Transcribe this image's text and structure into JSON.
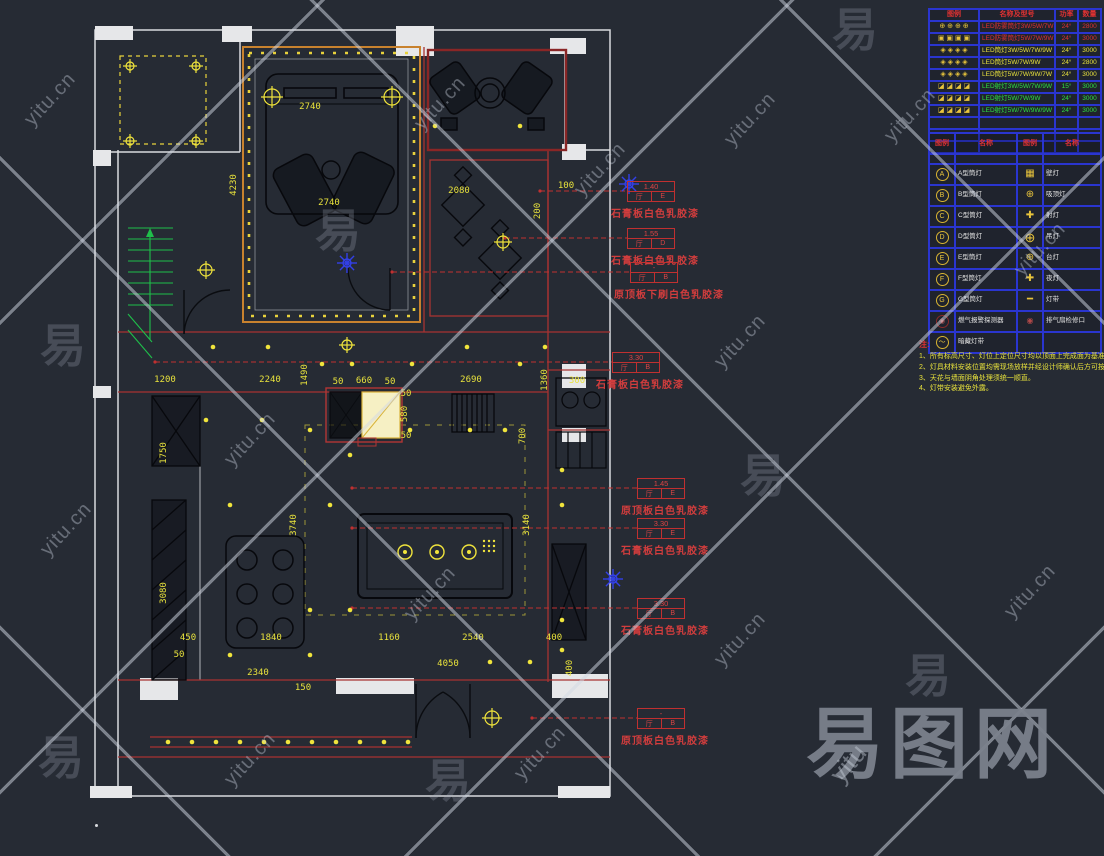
{
  "watermark": {
    "url": "yitu.cn",
    "glyph": "易",
    "brand": "易图网",
    "brand_sub": "yitu"
  },
  "fixture_legend": {
    "headers": [
      "图例",
      "名称及型号",
      "功率",
      "数量"
    ],
    "rows": [
      {
        "sym": "⊕ ⊕ ⊕ ⊕",
        "color": "red",
        "name": "LED防雾筒灯3W/5W/7W",
        "power": "24°",
        "qty": "2800"
      },
      {
        "sym": "▣ ▣ ▣ ▣",
        "color": "red",
        "name": "LED防雾筒灯5W/7W/9W",
        "power": "24°",
        "qty": "3000"
      },
      {
        "sym": "◈ ◈ ◈ ◈",
        "color": "yellow",
        "name": "LED筒灯3W/5W/7W/9W",
        "power": "24°",
        "qty": "3000"
      },
      {
        "sym": "◈ ◈ ◈ ◈",
        "color": "yellow",
        "name": "LED筒灯5W/7W/9W",
        "power": "24°",
        "qty": "2800"
      },
      {
        "sym": "◈ ◈ ◈ ◈",
        "color": "yellow",
        "name": "LED筒灯5W/7W/9W/7W",
        "power": "24°",
        "qty": "3000"
      },
      {
        "sym": "◪ ◪ ◪ ◪",
        "color": "green",
        "name": "LED射灯3W/5W/7W/9W",
        "power": "15°",
        "qty": "3000"
      },
      {
        "sym": "◪ ◪ ◪ ◪",
        "color": "green",
        "name": "LED射灯5W/7W/9W",
        "power": "24°",
        "qty": "3000"
      },
      {
        "sym": "◪ ◪ ◪ ◪",
        "color": "green",
        "name": "LED射灯5W/7W/9W/9W",
        "power": "24°",
        "qty": "3000"
      }
    ],
    "empty_rows": 3
  },
  "symbol_legend": {
    "headers": [
      "图例",
      "名称",
      "图例",
      "名称"
    ],
    "rows": [
      {
        "lsym": "A",
        "lname": "A型筒灯",
        "rsym": "▦",
        "rname": "壁灯"
      },
      {
        "lsym": "B",
        "lname": "B型筒灯",
        "rsym": "⊕",
        "rname": "吸顶灯"
      },
      {
        "lsym": "C",
        "lname": "C型筒灯",
        "rsym": "✚",
        "rname": "射灯"
      },
      {
        "lsym": "D",
        "lname": "D型筒灯",
        "rsym": "⊕",
        "rname": "吊灯",
        "rbig": true
      },
      {
        "lsym": "E",
        "lname": "E型筒灯",
        "rsym": "⊕",
        "rname": "台灯"
      },
      {
        "lsym": "F",
        "lname": "F型筒灯",
        "rsym": "✚",
        "rname": "夜灯"
      },
      {
        "lsym": "G",
        "lname": "G型筒灯",
        "rsym": "━",
        "rname": "灯带"
      },
      {
        "lsym": "◉",
        "lname": "燃气报警探测器",
        "rsym": "◉",
        "rname": "排气扇检修口",
        "danger": true
      },
      {
        "lsym": "〜",
        "lname": "暗藏灯带",
        "rsym": "",
        "rname": ""
      }
    ]
  },
  "notes": {
    "title": "注:",
    "items": [
      "1、所有标高尺寸、灯位上定位尺寸均以顶面上完成面为基准。",
      "2、灯具材料安装位置均需现场放样并经设计师确认后方可按图施工预留。",
      "3、天花与墙面阴角处理须统一顺直。",
      "4、灯带安装避免外露。"
    ]
  },
  "callouts": [
    {
      "value": "1.40",
      "room": "厅",
      "code": "E",
      "label": "石膏板白色乳胶漆",
      "x": 627,
      "y": 181,
      "tx": 540
    },
    {
      "value": "1.55",
      "room": "厅",
      "code": "D",
      "label": "石膏板白色乳胶漆",
      "x": 627,
      "y": 228,
      "tx": 505
    },
    {
      "value": "-",
      "room": "厅",
      "code": "B",
      "label": "原顶板下刷白色乳胶漆",
      "x": 630,
      "y": 262,
      "tx": 392
    },
    {
      "value": "3.30",
      "room": "厅",
      "code": "B",
      "label": "石膏板白色乳胶漆",
      "x": 612,
      "y": 352,
      "tx": 155
    },
    {
      "value": "1.45",
      "room": "厅",
      "code": "E",
      "label": "原顶板白色乳胶漆",
      "x": 637,
      "y": 478,
      "tx": 352
    },
    {
      "value": "3.30",
      "room": "厅",
      "code": "E",
      "label": "石膏板白色乳胶漆",
      "x": 637,
      "y": 518,
      "tx": 352
    },
    {
      "value": "3.30",
      "room": "厅",
      "code": "B",
      "label": "石膏板白色乳胶漆",
      "x": 637,
      "y": 598,
      "tx": 352
    },
    {
      "value": "-",
      "room": "厅",
      "code": "B",
      "label": "原顶板白色乳胶漆",
      "x": 637,
      "y": 708,
      "tx": 532
    }
  ],
  "dims": [
    {
      "t": "2740",
      "x": 310,
      "y": 109,
      "r": 0
    },
    {
      "t": "4230",
      "x": 236,
      "y": 185,
      "r": -90
    },
    {
      "t": "2740",
      "x": 329,
      "y": 205,
      "r": 0
    },
    {
      "t": "2080",
      "x": 459,
      "y": 193,
      "r": 0
    },
    {
      "t": "100",
      "x": 566,
      "y": 188,
      "r": 0
    },
    {
      "t": "200",
      "x": 540,
      "y": 211,
      "r": -90
    },
    {
      "t": "1200",
      "x": 165,
      "y": 382,
      "r": 0
    },
    {
      "t": "2240",
      "x": 270,
      "y": 382,
      "r": 0
    },
    {
      "t": "1490",
      "x": 307,
      "y": 375,
      "r": -90
    },
    {
      "t": "50",
      "x": 338,
      "y": 384,
      "r": 0
    },
    {
      "t": "660",
      "x": 364,
      "y": 383,
      "r": 0
    },
    {
      "t": "50",
      "x": 390,
      "y": 384,
      "r": 0
    },
    {
      "t": "2690",
      "x": 471,
      "y": 382,
      "r": 0
    },
    {
      "t": "1360",
      "x": 547,
      "y": 380,
      "r": -90
    },
    {
      "t": "300",
      "x": 577,
      "y": 383,
      "r": 0
    },
    {
      "t": "50",
      "x": 406,
      "y": 396,
      "r": 0
    },
    {
      "t": "580",
      "x": 407,
      "y": 414,
      "r": -90
    },
    {
      "t": "50",
      "x": 406,
      "y": 438,
      "r": 0
    },
    {
      "t": "700",
      "x": 525,
      "y": 436,
      "r": -90
    },
    {
      "t": "1750",
      "x": 166,
      "y": 453,
      "r": -90
    },
    {
      "t": "3080",
      "x": 166,
      "y": 593,
      "r": -90
    },
    {
      "t": "3740",
      "x": 296,
      "y": 525,
      "r": -90
    },
    {
      "t": "3140",
      "x": 529,
      "y": 525,
      "r": -90
    },
    {
      "t": "450",
      "x": 188,
      "y": 640,
      "r": 0
    },
    {
      "t": "1840",
      "x": 271,
      "y": 640,
      "r": 0
    },
    {
      "t": "1160",
      "x": 389,
      "y": 640,
      "r": 0
    },
    {
      "t": "2540",
      "x": 473,
      "y": 640,
      "r": 0
    },
    {
      "t": "400",
      "x": 554,
      "y": 640,
      "r": 0
    },
    {
      "t": "50",
      "x": 179,
      "y": 657,
      "r": 0
    },
    {
      "t": "4050",
      "x": 448,
      "y": 666,
      "r": 0
    },
    {
      "t": "400",
      "x": 572,
      "y": 668,
      "r": -90
    },
    {
      "t": "2340",
      "x": 258,
      "y": 675,
      "r": 0
    },
    {
      "t": "150",
      "x": 303,
      "y": 690,
      "r": 0
    }
  ],
  "lights": {
    "dots": [
      [
        213,
        347
      ],
      [
        268,
        347
      ],
      [
        322,
        364
      ],
      [
        352,
        364
      ],
      [
        412,
        364
      ],
      [
        467,
        347
      ],
      [
        520,
        364
      ],
      [
        545,
        347
      ],
      [
        206,
        420
      ],
      [
        262,
        420
      ],
      [
        310,
        430
      ],
      [
        350,
        455
      ],
      [
        410,
        430
      ],
      [
        470,
        430
      ],
      [
        505,
        430
      ],
      [
        230,
        505
      ],
      [
        330,
        505
      ],
      [
        310,
        610
      ],
      [
        350,
        610
      ],
      [
        230,
        655
      ],
      [
        310,
        655
      ],
      [
        562,
        470
      ],
      [
        562,
        505
      ],
      [
        562,
        620
      ],
      [
        562,
        650
      ],
      [
        530,
        662
      ],
      [
        490,
        662
      ],
      [
        435,
        126
      ],
      [
        520,
        126
      ],
      [
        168,
        742
      ],
      [
        192,
        742
      ],
      [
        216,
        742
      ],
      [
        240,
        742
      ],
      [
        264,
        742
      ],
      [
        288,
        742
      ],
      [
        312,
        742
      ],
      [
        336,
        742
      ],
      [
        360,
        742
      ],
      [
        384,
        742
      ],
      [
        408,
        742
      ]
    ],
    "crosses": [
      {
        "x": 272,
        "y": 97,
        "r": 8
      },
      {
        "x": 392,
        "y": 97,
        "r": 8
      },
      {
        "x": 206,
        "y": 270,
        "r": 6
      },
      {
        "x": 503,
        "y": 242,
        "r": 6
      },
      {
        "x": 492,
        "y": 718,
        "r": 7
      },
      {
        "x": 347,
        "y": 345,
        "r": 5
      },
      {
        "x": 130,
        "y": 66,
        "r": 4
      },
      {
        "x": 196,
        "y": 66,
        "r": 4
      },
      {
        "x": 130,
        "y": 141,
        "r": 4
      },
      {
        "x": 196,
        "y": 141,
        "r": 4
      }
    ],
    "rings": [
      [
        405,
        552
      ],
      [
        437,
        552
      ],
      [
        469,
        552
      ]
    ],
    "blue": [
      [
        347,
        263
      ],
      [
        629,
        184
      ],
      [
        613,
        579
      ]
    ]
  }
}
